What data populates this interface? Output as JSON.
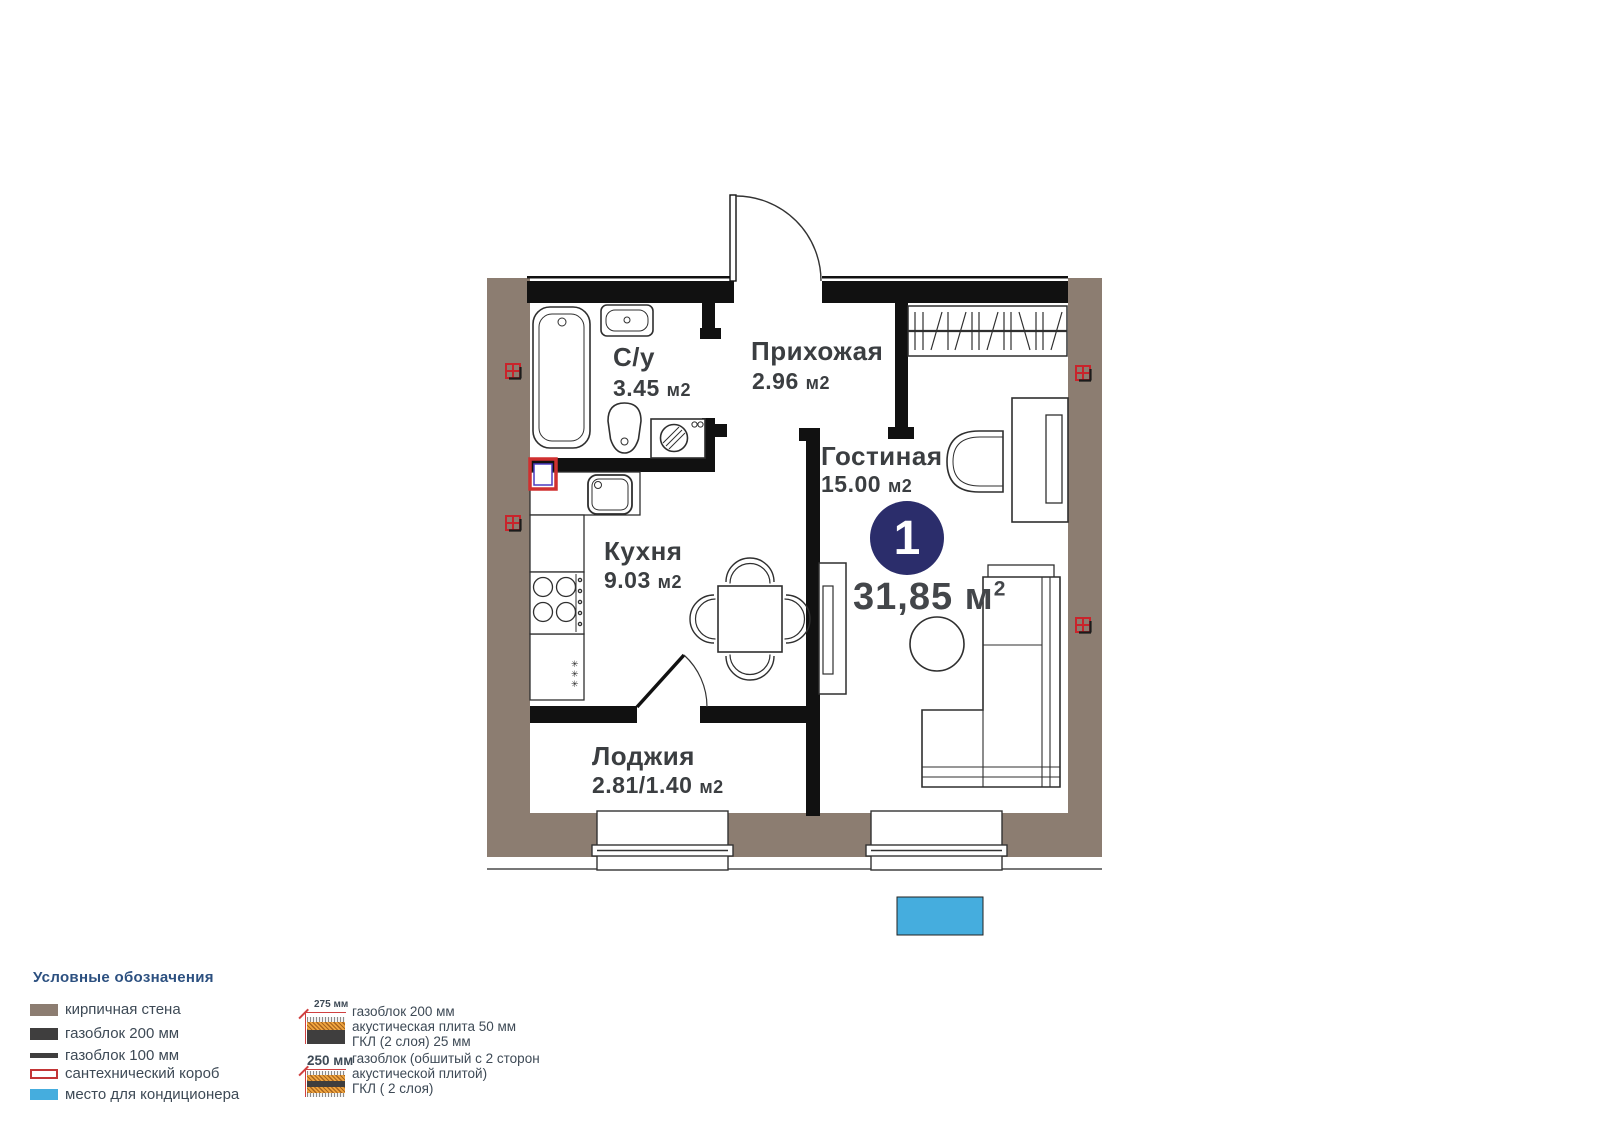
{
  "plan": {
    "badge_number": "1",
    "total_area_label": "31,85 м",
    "total_area_sup": "2",
    "fridge_symbol": "✳\n✳\n✳",
    "rooms": {
      "bathroom": {
        "name": "С/у",
        "area": "3.45",
        "unit": "м2"
      },
      "hallway": {
        "name": "Прихожая",
        "area": "2.96",
        "unit": "м2"
      },
      "living": {
        "name": "Гостиная",
        "area": "15.00",
        "unit": "м2"
      },
      "kitchen": {
        "name": "Кухня",
        "area": "9.03",
        "unit": "м2"
      },
      "loggia": {
        "name": "Лоджия",
        "area": "2.81/1.40",
        "unit": "м2"
      }
    }
  },
  "legend": {
    "title": "Условные обозначения",
    "items": [
      {
        "label": "кирпичная стена"
      },
      {
        "label": "газоблок 200 мм"
      },
      {
        "label": "газоблок 100 мм"
      },
      {
        "label": "сантехнический короб"
      },
      {
        "label": "место для кондиционера"
      }
    ],
    "wall_sections": [
      {
        "dimension": "275 мм",
        "line1": "газоблок 200 мм",
        "line2": "акустическая плита 50 мм",
        "line3": "ГКЛ (2 слоя) 25 мм"
      },
      {
        "dimension": "250 мм",
        "line1": "газоблок (обшитый с 2 сторон",
        "line2": "акустической плитой)",
        "line3": "ГКЛ ( 2 слоя)"
      }
    ]
  },
  "colors": {
    "brick": "#8C7D71",
    "block": "#111111",
    "accent_blue": "#45ADDE",
    "badge_navy": "#2B2D6B",
    "red": "#CF3333"
  }
}
